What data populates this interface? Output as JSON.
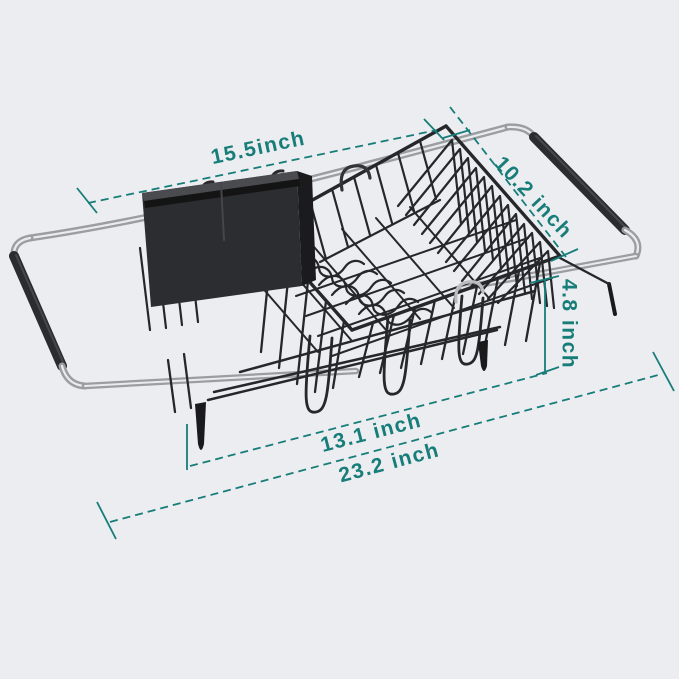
{
  "title": "Expandable over-sink dish drying rack — dimension diagram",
  "background_color": "#ecedf1",
  "accent_color": "#177d79",
  "product": {
    "name": "expandable-dish-drying-rack",
    "visible_parts": [
      "extendable chrome arm left",
      "extendable chrome arm right",
      "black rubber grips",
      "black wire basket",
      "plate divider zigzag wires",
      "utensil caddy",
      "drain feet"
    ],
    "colors": {
      "wire": "#26272a",
      "chrome": "#9a9da2",
      "chrome_highlight": "#e9ebed",
      "grip": "#2b2c2f",
      "caddy": "#2c2d30"
    }
  },
  "dimensions": {
    "top_width": {
      "label": "15.5inch",
      "value": 15.5,
      "unit": "inch",
      "measures": "basket top width"
    },
    "depth": {
      "label": "10.2 inch",
      "value": 10.2,
      "unit": "inch",
      "measures": "basket depth"
    },
    "height": {
      "label": "4.8 inch",
      "value": 4.8,
      "unit": "inch",
      "measures": "basket height"
    },
    "bottom_width": {
      "label": "13.1 inch",
      "value": 13.1,
      "unit": "inch",
      "measures": "basket bottom width"
    },
    "max_length": {
      "label": "23.2 inch",
      "value": 23.2,
      "unit": "inch",
      "measures": "fully extended length"
    }
  }
}
